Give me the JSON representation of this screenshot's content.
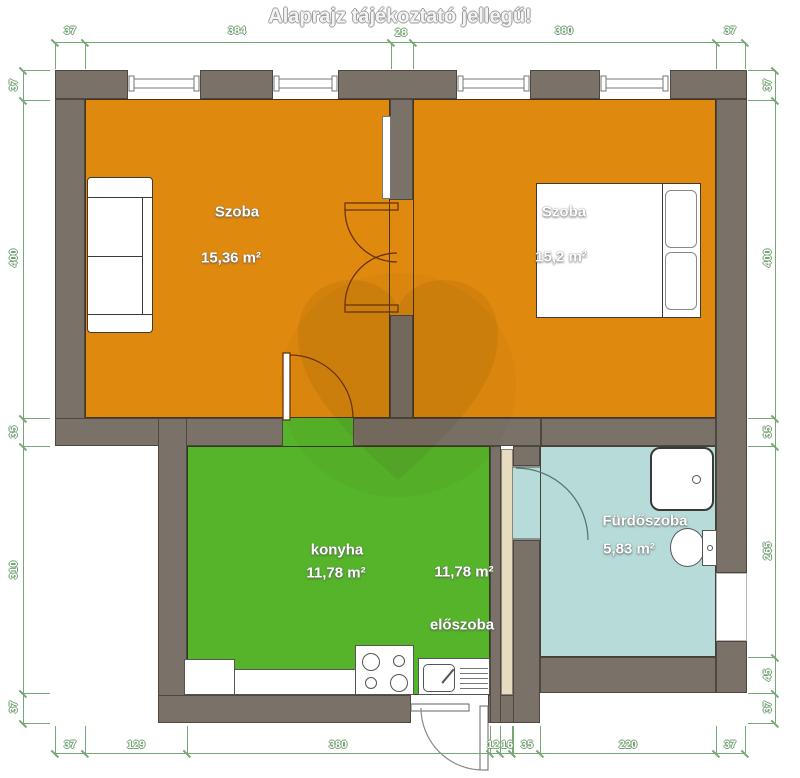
{
  "title": "Alaprajz tájékoztató jellegű!",
  "rooms": {
    "szoba1": {
      "name": "Szoba",
      "area": "15,36 m²"
    },
    "szoba2": {
      "name": "Szoba",
      "area": "15,2 m²"
    },
    "konyha": {
      "name": "konyha",
      "area": "11,78 m²"
    },
    "eloszoba": {
      "name": "előszoba",
      "area": "11,78 m²"
    },
    "furdoszoba": {
      "name": "Fürdőszoba",
      "area": "5,83 m²"
    }
  },
  "dimensions": {
    "top": [
      "37",
      "384",
      "28",
      "380",
      "37"
    ],
    "bottom": [
      "37",
      "129",
      "380",
      "12",
      "16",
      "35",
      "220",
      "37"
    ],
    "left": [
      "37",
      "400",
      "35",
      "310",
      "37"
    ],
    "right": [
      "37",
      "400",
      "35",
      "265",
      "45",
      "37"
    ]
  },
  "colors": {
    "wall": "#7a7269",
    "orange": "#e0890f",
    "green": "#55b42a",
    "teal": "#b7dbd8",
    "dim": "#76a876",
    "tan": "#e7dcc0"
  }
}
